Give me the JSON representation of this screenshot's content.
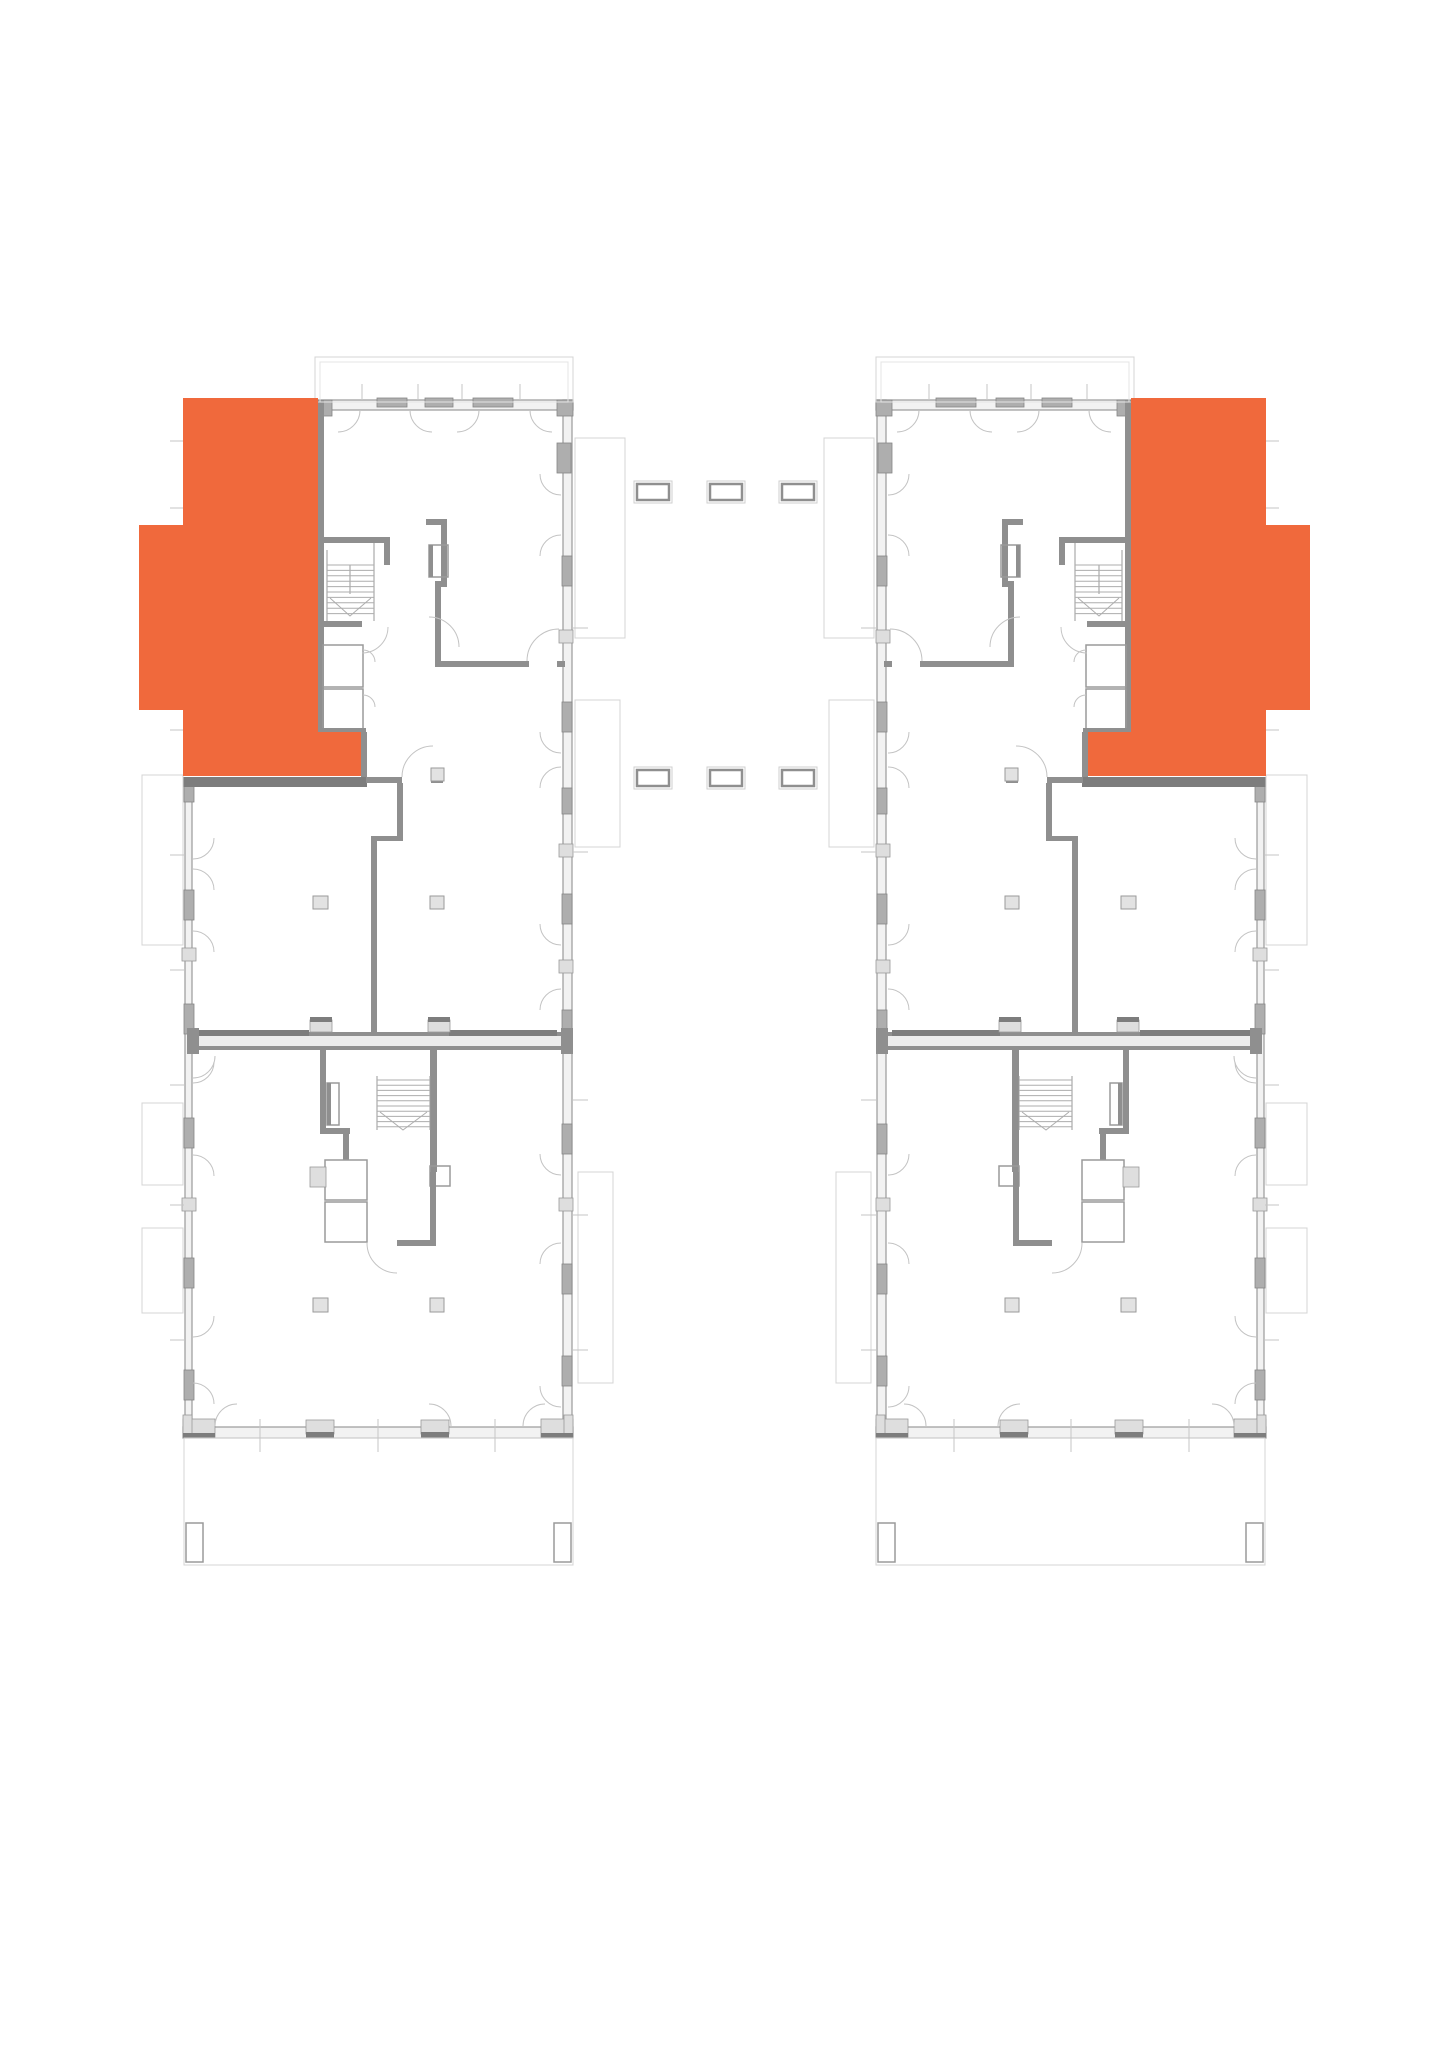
{
  "canvas": {
    "w": 1449,
    "h": 2048,
    "bg": "#ffffff"
  },
  "plan_title": "floor-plan-two-wings",
  "highlight_color": "#F0693C",
  "mirror_axis": 1449,
  "styles": {
    "wallFill": {
      "fill": "#f2f2f2",
      "stroke": "#9a9a9a",
      "sw": 1.2
    },
    "wallMed": {
      "fill": "#8f8f8f"
    },
    "wallHeavy": {
      "fill": "#7d7d7d"
    },
    "winDark": {
      "fill": "#aeaeae",
      "stroke": "#858585",
      "sw": 0.8
    },
    "blockLight": {
      "fill": "#dedede",
      "stroke": "#9a9a9a",
      "sw": 0.8
    },
    "partyFill": {
      "fill": "#ececec"
    },
    "outline": {
      "fill": "none",
      "stroke": "#d4d4d4",
      "sw": 1
    },
    "outline2": {
      "fill": "none",
      "stroke": "#e4e4e4",
      "sw": 1
    },
    "thin": {
      "fill": "none",
      "stroke": "#9a9a9a",
      "sw": 1
    },
    "lightLine": {
      "fill": "none",
      "stroke": "#c6c6c6",
      "sw": 1
    },
    "arc": {
      "fill": "none",
      "stroke": "#c3c3c3",
      "sw": 1
    },
    "tread": {
      "fill": "none",
      "stroke": "#adadad",
      "sw": 1
    },
    "boxWall": {
      "fill": "none",
      "stroke": "#9a9a9a",
      "sw": 1.5
    },
    "column": {
      "fill": "#e2e2e2",
      "stroke": "#9a9a9a",
      "sw": 1
    },
    "dashOuter": {
      "fill": "none",
      "stroke": "#cfcfcf",
      "sw": 1
    },
    "dashInner": {
      "fill": "#ffffff",
      "stroke": "#8f8f8f",
      "sw": 2.5
    },
    "unit": {
      "fill": "#F0693C"
    }
  },
  "unit": {
    "points": [
      [
        183,
        398
      ],
      [
        318,
        398
      ],
      [
        318,
        732
      ],
      [
        361,
        732
      ],
      [
        361,
        776
      ],
      [
        183,
        776
      ],
      [
        183,
        710
      ],
      [
        139,
        710
      ],
      [
        139,
        525
      ],
      [
        183,
        525
      ]
    ]
  },
  "building": {
    "rects": [
      [
        318,
        400,
        255,
        10,
        "wallFill"
      ],
      [
        563,
        400,
        9,
        1027,
        "wallFill"
      ],
      [
        185,
        786,
        7,
        641,
        "wallFill"
      ],
      [
        183,
        1427,
        390,
        11,
        "wallFill"
      ],
      [
        318,
        400,
        14,
        16,
        "winDark"
      ],
      [
        557,
        400,
        16,
        16,
        "winDark"
      ],
      [
        557,
        443,
        14,
        30,
        "winDark"
      ],
      [
        377,
        398,
        30,
        9,
        "winDark"
      ],
      [
        425,
        398,
        28,
        9,
        "winDark"
      ],
      [
        473,
        398,
        40,
        9,
        "winDark"
      ],
      [
        562,
        556,
        10,
        30,
        "winDark"
      ],
      [
        562,
        702,
        10,
        30,
        "winDark"
      ],
      [
        562,
        788,
        10,
        26,
        "winDark"
      ],
      [
        562,
        894,
        10,
        30,
        "winDark"
      ],
      [
        562,
        1010,
        10,
        30,
        "winDark"
      ],
      [
        562,
        1124,
        10,
        30,
        "winDark"
      ],
      [
        562,
        1264,
        10,
        30,
        "winDark"
      ],
      [
        562,
        1356,
        10,
        30,
        "winDark"
      ],
      [
        559,
        630,
        14,
        13,
        "blockLight"
      ],
      [
        559,
        844,
        14,
        13,
        "blockLight"
      ],
      [
        559,
        960,
        14,
        13,
        "blockLight"
      ],
      [
        559,
        1198,
        14,
        13,
        "blockLight"
      ],
      [
        184,
        890,
        10,
        30,
        "winDark"
      ],
      [
        184,
        1004,
        10,
        30,
        "winDark"
      ],
      [
        184,
        1118,
        10,
        30,
        "winDark"
      ],
      [
        184,
        1258,
        10,
        30,
        "winDark"
      ],
      [
        184,
        1370,
        10,
        30,
        "winDark"
      ],
      [
        182,
        948,
        14,
        13,
        "blockLight"
      ],
      [
        182,
        1198,
        14,
        13,
        "blockLight"
      ],
      [
        184,
        786,
        10,
        16,
        "winDark"
      ],
      [
        183,
        1419,
        32,
        19,
        "blockLight"
      ],
      [
        183,
        1415,
        9,
        23,
        "blockLight"
      ],
      [
        541,
        1419,
        32,
        19,
        "blockLight"
      ],
      [
        564,
        1415,
        9,
        23,
        "blockLight"
      ],
      [
        183,
        1433,
        32,
        5,
        "wallHeavy"
      ],
      [
        541,
        1433,
        32,
        5,
        "wallHeavy"
      ],
      [
        306,
        1420,
        28,
        14,
        "blockLight"
      ],
      [
        306,
        1432,
        28,
        6,
        "wallHeavy"
      ],
      [
        421,
        1420,
        28,
        14,
        "blockLight"
      ],
      [
        421,
        1432,
        28,
        6,
        "wallHeavy"
      ],
      [
        187,
        1032,
        386,
        18,
        "partyFill"
      ],
      [
        187,
        1032,
        386,
        4,
        "wallMed"
      ],
      [
        187,
        1046,
        386,
        4,
        "wallMed"
      ],
      [
        187,
        1028,
        12,
        26,
        "wallMed"
      ],
      [
        561,
        1028,
        12,
        26,
        "wallMed"
      ],
      [
        199,
        1030,
        110,
        6,
        "wallHeavy"
      ],
      [
        449,
        1030,
        108,
        6,
        "wallHeavy"
      ],
      [
        310,
        1020,
        22,
        12,
        "blockLight"
      ],
      [
        310,
        1017,
        22,
        5,
        "wallHeavy"
      ],
      [
        428,
        1020,
        22,
        12,
        "blockLight"
      ],
      [
        428,
        1017,
        22,
        5,
        "wallHeavy"
      ],
      [
        318,
        400,
        6,
        140,
        "wallMed"
      ],
      [
        318,
        537,
        72,
        6,
        "wallMed"
      ],
      [
        318,
        543,
        6,
        90,
        "wallMed"
      ],
      [
        441,
        519,
        6,
        68,
        "wallMed"
      ],
      [
        426,
        519,
        21,
        6,
        "wallMed"
      ],
      [
        384,
        543,
        6,
        22,
        "wallMed"
      ],
      [
        429,
        545,
        19,
        32,
        "boxWall"
      ],
      [
        429,
        545,
        4,
        32,
        "wallMed"
      ],
      [
        435,
        581,
        12,
        6,
        "wallMed"
      ],
      [
        435,
        586,
        6,
        80,
        "wallMed"
      ],
      [
        435,
        661,
        94,
        6,
        "wallMed"
      ],
      [
        557,
        661,
        8,
        6,
        "wallMed"
      ],
      [
        318,
        627,
        6,
        105,
        "wallMed"
      ],
      [
        318,
        621,
        44,
        6,
        "wallMed"
      ],
      [
        323,
        645,
        40,
        42,
        "boxWall"
      ],
      [
        323,
        689,
        40,
        42,
        "boxWall"
      ],
      [
        318,
        728,
        48,
        5,
        "wallMed"
      ],
      [
        361,
        732,
        6,
        45,
        "wallMed"
      ],
      [
        183,
        777,
        184,
        10,
        "wallHeavy"
      ],
      [
        366,
        777,
        36,
        6,
        "wallMed"
      ],
      [
        431,
        777,
        12,
        6,
        "wallMed"
      ],
      [
        397,
        783,
        6,
        56,
        "wallMed"
      ],
      [
        371,
        836,
        32,
        5,
        "wallMed"
      ],
      [
        371,
        841,
        6,
        193,
        "wallMed"
      ],
      [
        320,
        1050,
        6,
        84,
        "wallMed"
      ],
      [
        320,
        1128,
        30,
        6,
        "wallMed"
      ],
      [
        343,
        1134,
        6,
        26,
        "wallMed"
      ],
      [
        325,
        1160,
        42,
        40,
        "boxWall"
      ],
      [
        325,
        1202,
        42,
        40,
        "boxWall"
      ],
      [
        310,
        1167,
        16,
        20,
        "blockLight"
      ],
      [
        430,
        1050,
        7,
        122,
        "wallMed"
      ],
      [
        430,
        1166,
        20,
        20,
        "boxWall"
      ],
      [
        430,
        1172,
        6,
        70,
        "wallMed"
      ],
      [
        397,
        1240,
        39,
        6,
        "wallMed"
      ],
      [
        327,
        1083,
        12,
        42,
        "boxWall"
      ],
      [
        327,
        1083,
        4,
        42,
        "wallMed"
      ],
      [
        313,
        896,
        15,
        13,
        "column"
      ],
      [
        430,
        896,
        14,
        13,
        "column"
      ],
      [
        431,
        768,
        13,
        13,
        "column"
      ],
      [
        313,
        1298,
        15,
        14,
        "column"
      ],
      [
        430,
        1298,
        14,
        14,
        "column"
      ],
      [
        315,
        357,
        258,
        45,
        "outline"
      ],
      [
        320,
        362,
        248,
        40,
        "outline2"
      ],
      [
        575,
        438,
        50,
        200,
        "outline"
      ],
      [
        575,
        700,
        45,
        147,
        "outline"
      ],
      [
        578,
        1172,
        35,
        211,
        "outline"
      ],
      [
        142,
        775,
        41,
        170,
        "outline"
      ],
      [
        142,
        1103,
        41,
        82,
        "outline"
      ],
      [
        142,
        1228,
        41,
        85,
        "outline"
      ],
      [
        184,
        1438,
        389,
        127,
        "outline"
      ],
      [
        186,
        1523,
        17,
        39,
        "boxWall"
      ],
      [
        554,
        1523,
        17,
        39,
        "boxWall"
      ]
    ],
    "lines": [
      [
        260,
        1419,
        260,
        1452,
        "lightLine"
      ],
      [
        378,
        1419,
        378,
        1452,
        "lightLine"
      ],
      [
        495,
        1419,
        495,
        1452,
        "lightLine"
      ],
      [
        170,
        441,
        184,
        441,
        "lightLine"
      ],
      [
        170,
        508,
        184,
        508,
        "lightLine"
      ],
      [
        170,
        730,
        184,
        730,
        "lightLine"
      ],
      [
        170,
        855,
        184,
        855,
        "lightLine"
      ],
      [
        170,
        970,
        184,
        970,
        "lightLine"
      ],
      [
        170,
        1085,
        184,
        1085,
        "lightLine"
      ],
      [
        170,
        1205,
        184,
        1205,
        "lightLine"
      ],
      [
        170,
        1340,
        184,
        1340,
        "lightLine"
      ],
      [
        573,
        628,
        588,
        628,
        "lightLine"
      ],
      [
        573,
        852,
        588,
        852,
        "lightLine"
      ],
      [
        573,
        1100,
        588,
        1100,
        "lightLine"
      ],
      [
        573,
        1215,
        588,
        1215,
        "lightLine"
      ],
      [
        573,
        1350,
        588,
        1350,
        "lightLine"
      ],
      [
        362,
        384,
        362,
        400,
        "lightLine"
      ],
      [
        418,
        384,
        418,
        400,
        "lightLine"
      ],
      [
        462,
        384,
        462,
        400,
        "lightLine"
      ],
      [
        520,
        384,
        520,
        400,
        "lightLine"
      ],
      [
        327,
        550,
        327,
        621,
        "thin"
      ],
      [
        374,
        543,
        374,
        621,
        "thin"
      ],
      [
        350,
        565,
        350,
        594,
        "thin"
      ],
      [
        377,
        1076,
        377,
        1130,
        "thin"
      ],
      [
        430,
        1076,
        430,
        1130,
        "thin"
      ]
    ],
    "arcs": [
      [
        338,
        410,
        22,
        0,
        90
      ],
      [
        432,
        410,
        22,
        90,
        180
      ],
      [
        457,
        410,
        22,
        0,
        90
      ],
      [
        552,
        410,
        22,
        90,
        180
      ],
      [
        561,
        474,
        21,
        90,
        180
      ],
      [
        561,
        556,
        21,
        180,
        270
      ],
      [
        561,
        732,
        21,
        90,
        180
      ],
      [
        561,
        788,
        21,
        180,
        270
      ],
      [
        561,
        924,
        21,
        90,
        180
      ],
      [
        561,
        1010,
        21,
        180,
        270
      ],
      [
        561,
        1154,
        21,
        90,
        180
      ],
      [
        561,
        1264,
        21,
        180,
        270
      ],
      [
        561,
        1386,
        21,
        90,
        180
      ],
      [
        193,
        838,
        21,
        0,
        90
      ],
      [
        193,
        890,
        21,
        270,
        360
      ],
      [
        193,
        952,
        21,
        270,
        360
      ],
      [
        193,
        1062,
        21,
        0,
        90
      ],
      [
        193,
        1176,
        21,
        270,
        360
      ],
      [
        193,
        1316,
        21,
        0,
        90
      ],
      [
        193,
        1404,
        21,
        270,
        360
      ],
      [
        193,
        1056,
        22,
        0,
        90
      ],
      [
        237,
        1426,
        22,
        180,
        270
      ],
      [
        429,
        1426,
        22,
        270,
        360
      ],
      [
        545,
        1426,
        22,
        180,
        270
      ],
      [
        362,
        627,
        26,
        0,
        90
      ],
      [
        429,
        647,
        30,
        270,
        360
      ],
      [
        559,
        661,
        32,
        180,
        270
      ],
      [
        433,
        777,
        31,
        180,
        270
      ],
      [
        397,
        1243,
        30,
        90,
        180
      ],
      [
        363,
        662,
        12,
        270,
        360
      ],
      [
        363,
        707,
        12,
        270,
        360
      ]
    ],
    "treads": [
      [
        327,
        565,
        47,
        10,
        5.4
      ],
      [
        377,
        1080,
        53,
        10,
        5.2
      ]
    ],
    "polylines": [
      [
        [
          330,
          598,
          350,
          616,
          371,
          598
        ],
        "tread"
      ],
      [
        [
          380,
          1112,
          403,
          1130,
          427,
          1112
        ],
        "tread"
      ]
    ]
  },
  "connectors": {
    "rows": [
      {
        "y": 484,
        "xs": [
          637,
          710,
          782
        ],
        "w": 32,
        "h": 16
      },
      {
        "y": 770,
        "xs": [
          637,
          710,
          782
        ],
        "w": 32,
        "h": 16
      }
    ]
  }
}
